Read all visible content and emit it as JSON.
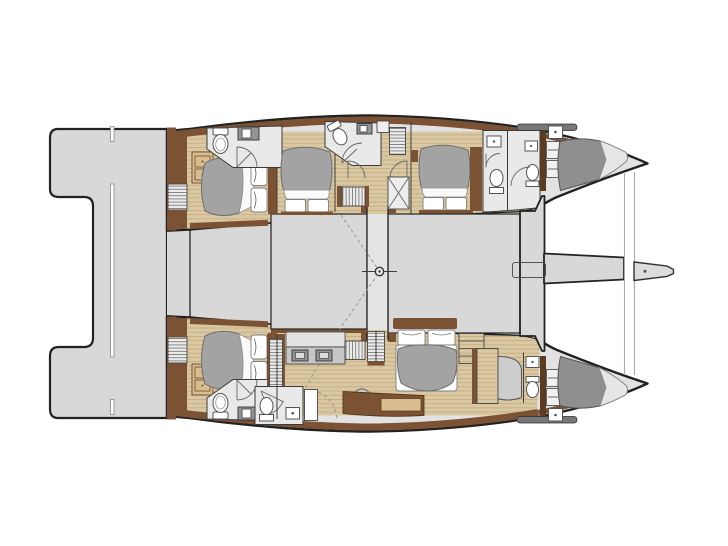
{
  "diagram": {
    "kind": "catamaran-interior-floor-plan",
    "orientation": "bow-right",
    "hulls": 2,
    "cabins_visible": 6
  },
  "colors": {
    "page": "#ffffff",
    "outline": "#222222",
    "deck": "#d8d8d8",
    "hullfloor": "#e2e2e2",
    "bath": "#e9e9e9",
    "walnut": "#7b5233",
    "walnutDark": "#5c3c21",
    "oak": "#d9bd8f",
    "wood": "#dac8a2",
    "woodLine": "#c3ab7e",
    "duvet": "#a3a3a3",
    "crew": "#8f8f8f",
    "partition": "#3c3c3c",
    "dashline": "#949494"
  },
  "icons": [
    "double-bed-icon",
    "pillow-icon",
    "toilet-icon",
    "sink-icon",
    "shower-door-icon",
    "stairs-icon",
    "wardrobe-louver-icon",
    "vanity-double-sink-icon",
    "stool-icon",
    "mast-step-icon",
    "bowsprit-icon",
    "crossbeam-icon",
    "trampoline-line-icon",
    "crew-berth-icon",
    "deck-hatch-icon",
    "door-swing-icon",
    "swim-platform-icon"
  ]
}
